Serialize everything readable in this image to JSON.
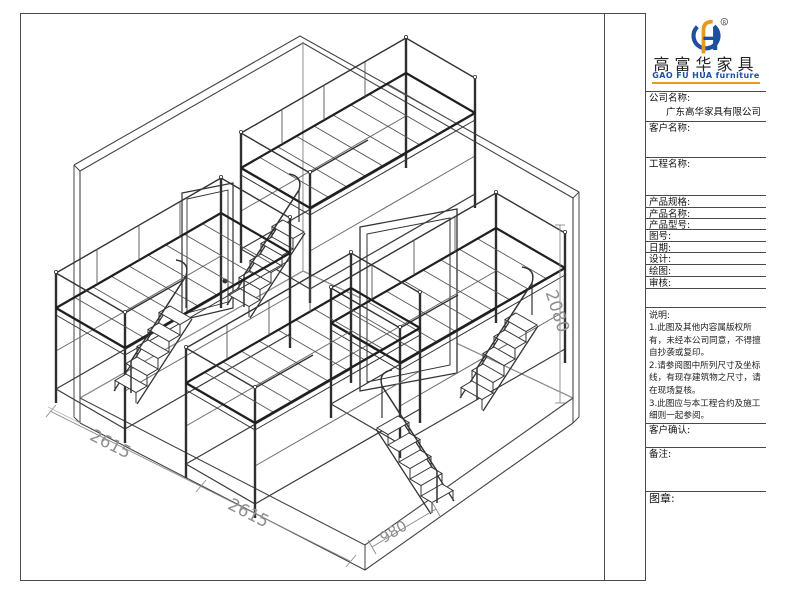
{
  "logo": {
    "cn_name": "高富华家具",
    "en_name": "GAO FU HUA furniture",
    "registered_mark": "R",
    "blue": "#1d4f9e",
    "orange": "#e6991f"
  },
  "title_block": {
    "company": {
      "label": "公司名称:",
      "value": "广东高华家具有限公司"
    },
    "customer": {
      "label": "客户名称:",
      "value": ""
    },
    "project": {
      "label": "工程名称:",
      "value": ""
    },
    "spec": {
      "label": "产品规格:",
      "value": ""
    },
    "product_name": {
      "label": "产品名称:",
      "value": ""
    },
    "model": {
      "label": "产品型号:",
      "value": ""
    },
    "drawing_no": {
      "label": "图号:",
      "value": ""
    },
    "date": {
      "label": "日期:",
      "value": ""
    },
    "design": {
      "label": "设计:",
      "value": ""
    },
    "draft": {
      "label": "绘图:",
      "value": ""
    },
    "review": {
      "label": "审核:",
      "value": ""
    },
    "confirm": {
      "label": "客户确认:",
      "value": ""
    },
    "remark": {
      "label": "备注:",
      "value": ""
    },
    "seal": {
      "label": "图章:",
      "value": ""
    }
  },
  "notes": {
    "title": "说明:",
    "lines": [
      "1.此图及其他内容属版权所有，未经本公司同意，不得擅自抄袭或复印。",
      "2.请参阅图中所列尺寸及坐标线，有现存建筑物之尺寸，请在现场复核。",
      "3.此图应与本工程合约及施工细则一起参阅。",
      "4.此图内容与以下工程合约有关。"
    ]
  },
  "dimensions": {
    "depth_a": "2615",
    "depth_b": "2615",
    "stair_width": "980",
    "height": "2080"
  },
  "drawing": {
    "description": "dormitory loft-bed room isometric drawing",
    "line_color": "#2f2f2f",
    "dim_color": "#8f8f8f"
  }
}
